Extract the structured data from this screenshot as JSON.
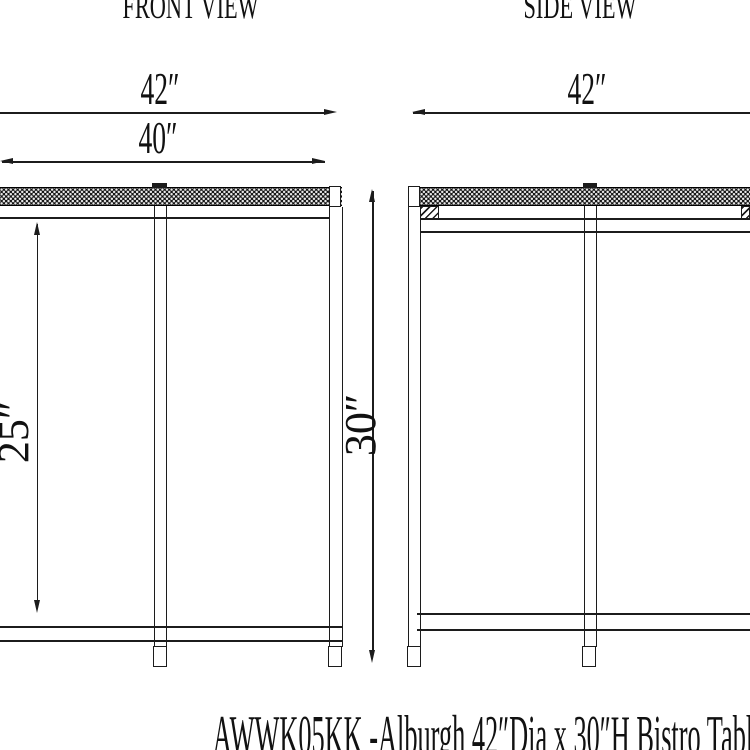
{
  "colors": {
    "background": "#ffffff",
    "line": "#1c1c1c"
  },
  "front_view": {
    "label": "FRONT VIEW",
    "dim_top_width": "42″",
    "dim_inner_width": "40″",
    "dim_clearance_height": "25″",
    "dim_overall_height": "30″"
  },
  "side_view": {
    "label": "SIDE VIEW",
    "dim_top_width": "42″"
  },
  "footer": {
    "title": "AWWK05KK -Alburgh 42″Dia x 30″H Bistro Table"
  }
}
